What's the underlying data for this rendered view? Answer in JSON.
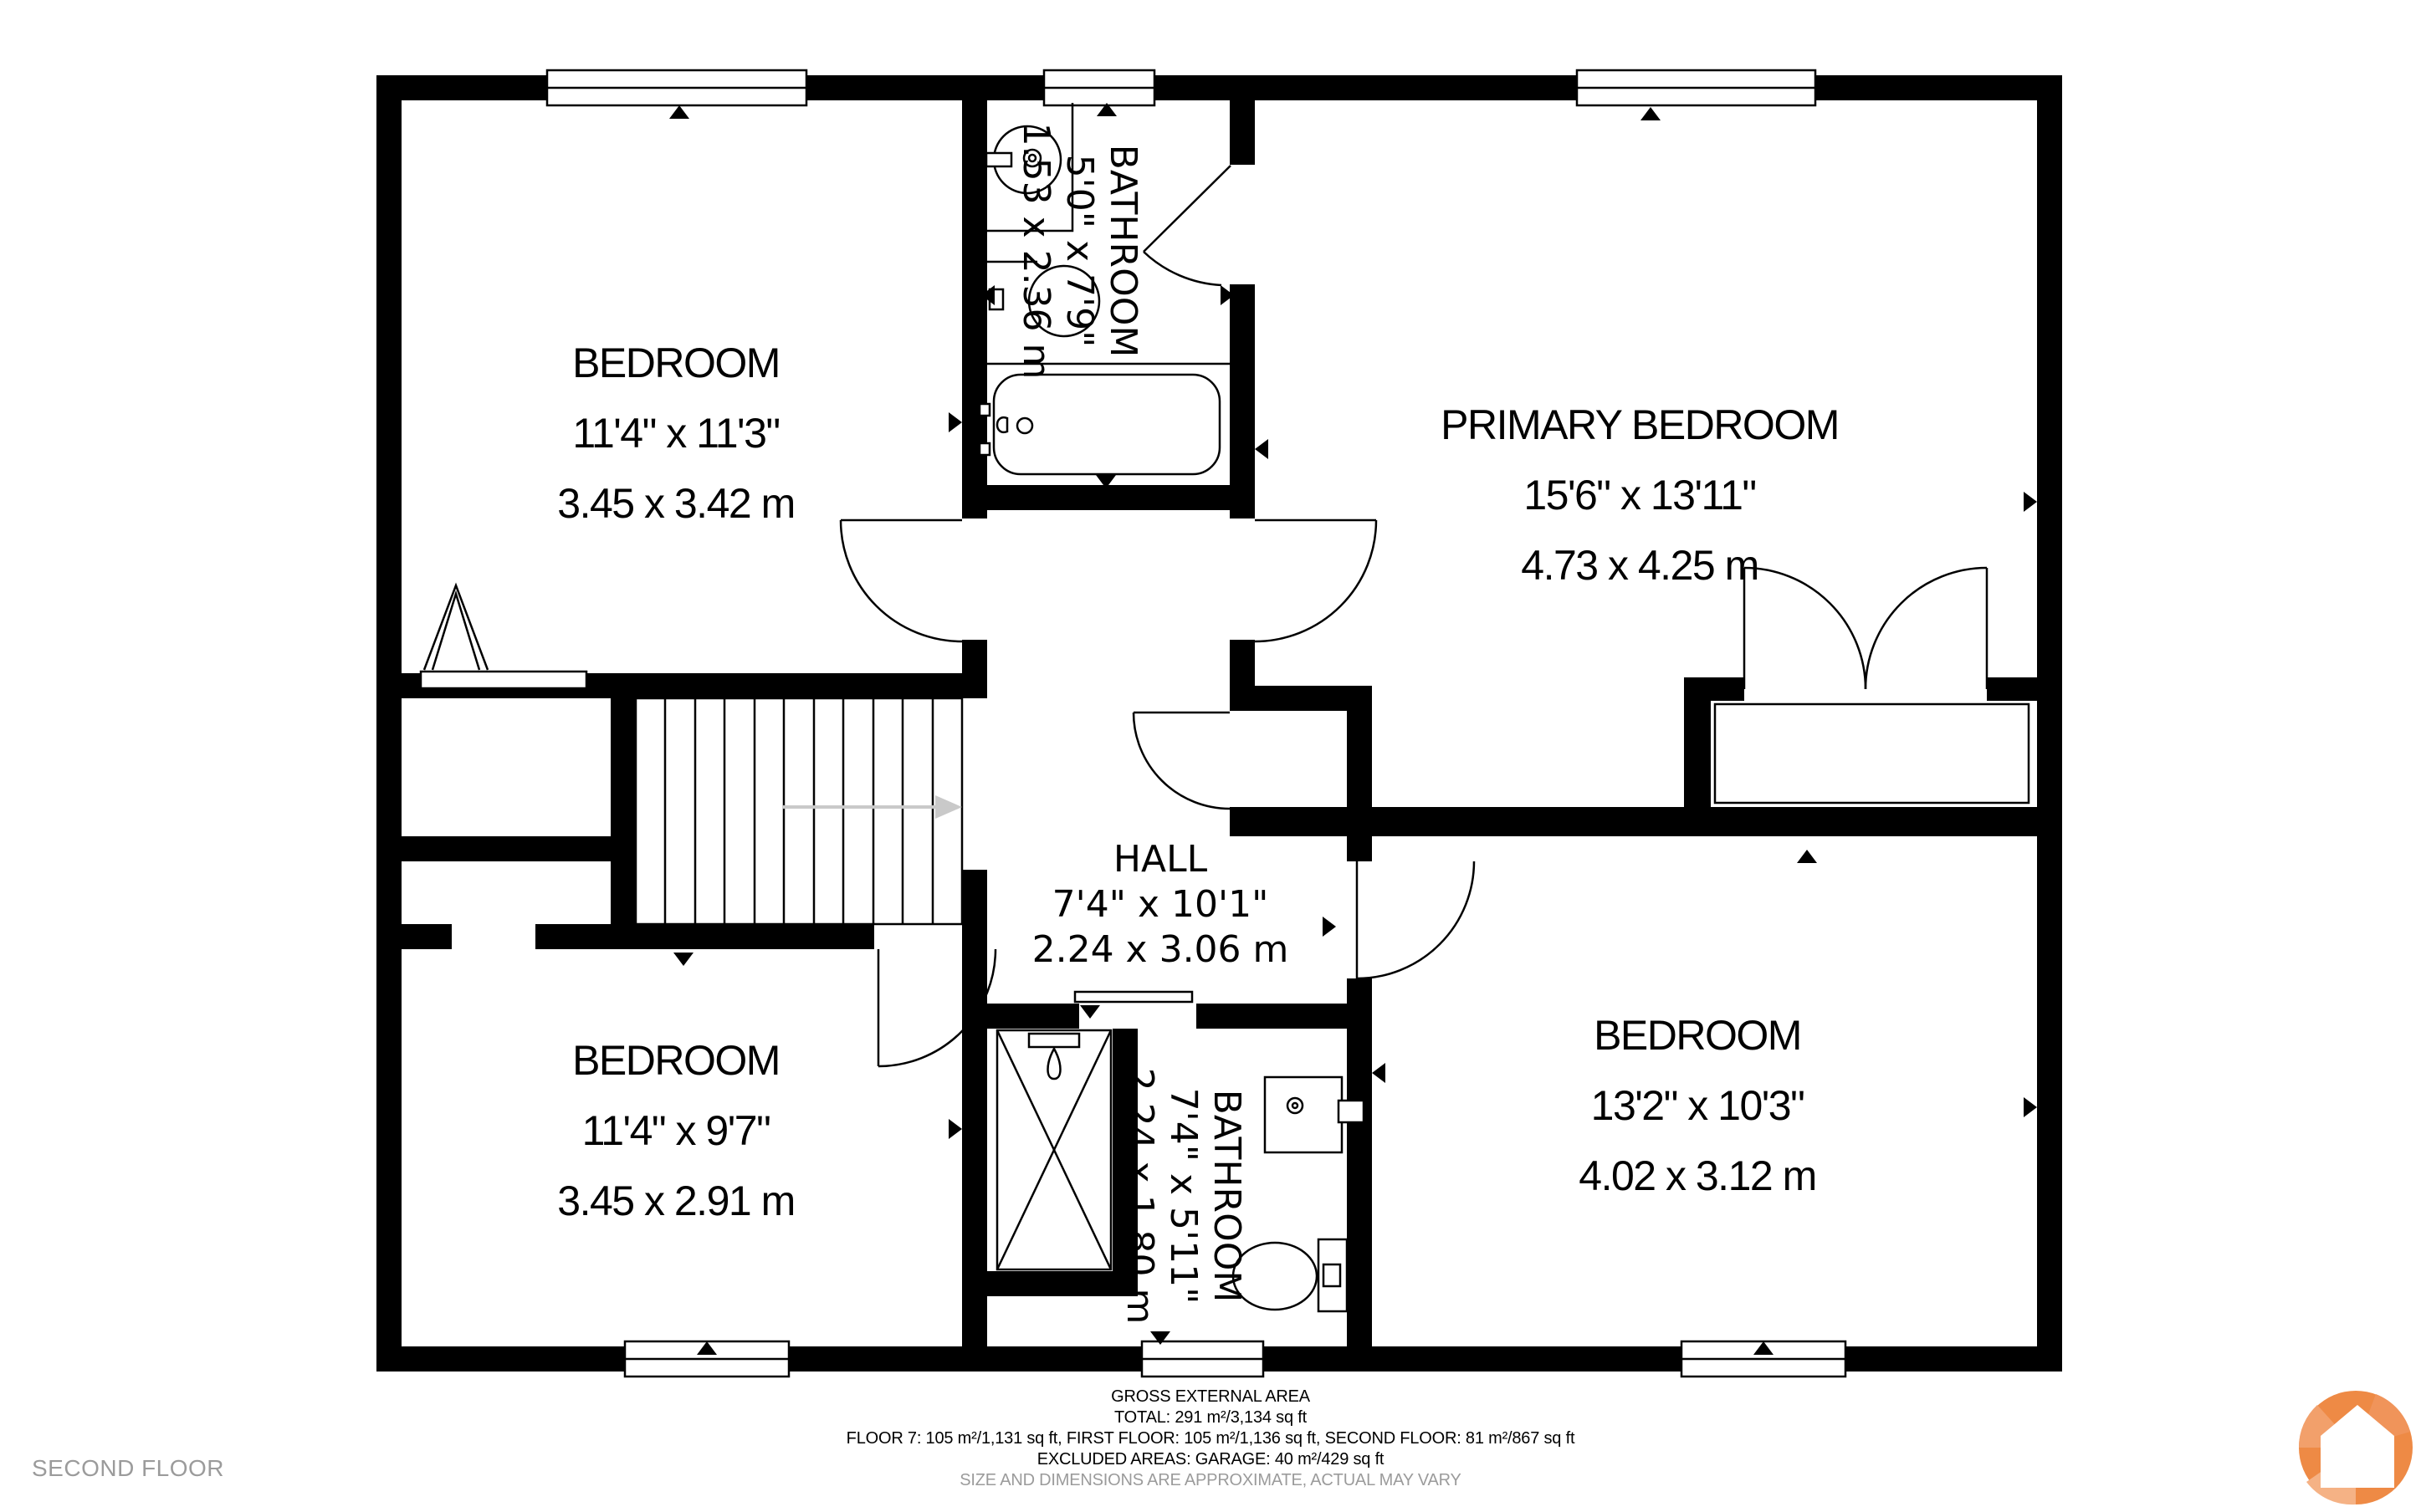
{
  "floor_label": "SECOND FLOOR",
  "rooms": [
    {
      "id": "bedroom-top-left",
      "name": "BEDROOM",
      "dim_ft": "11'4\" x 11'3\"",
      "dim_m": "3.45 x 3.42 m"
    },
    {
      "id": "bathroom-top",
      "name": "BATHROOM",
      "dim_ft": "5'0\" x 7'9\"",
      "dim_m": "1.53 x 2.36 m"
    },
    {
      "id": "primary-bedroom",
      "name": "PRIMARY BEDROOM",
      "dim_ft": "15'6\" x 13'11\"",
      "dim_m": "4.73 x 4.25 m"
    },
    {
      "id": "hall",
      "name": "HALL",
      "dim_ft": "7'4\" x 10'1\"",
      "dim_m": "2.24 x 3.06 m"
    },
    {
      "id": "bedroom-bottom-left",
      "name": "BEDROOM",
      "dim_ft": "11'4\" x 9'7\"",
      "dim_m": "3.45 x 2.91 m"
    },
    {
      "id": "bathroom-bottom",
      "name": "BATHROOM",
      "dim_ft": "7'4\" x 5'11\"",
      "dim_m": "2.24 x 1.80 m"
    },
    {
      "id": "bedroom-bottom-right",
      "name": "BEDROOM",
      "dim_ft": "13'2\" x 10'3\"",
      "dim_m": "4.02 x 3.12 m"
    }
  ],
  "footer": {
    "title": "GROSS EXTERNAL AREA",
    "total": "TOTAL: 291 m²/3,134 sq ft",
    "floors": "FLOOR 7: 105 m²/1,131 sq ft, FIRST FLOOR: 105 m²/1,136 sq ft, SECOND FLOOR: 81 m²/867 sq ft",
    "excluded": "EXCLUDED AREAS: GARAGE: 40 m²/429 sq ft",
    "disclaimer": "SIZE AND DIMENSIONS ARE APPROXIMATE, ACTUAL MAY VARY"
  },
  "colors": {
    "wall_black": "#000000",
    "logo_orange": "#EE8A45",
    "logo_orange_mid": "#F2A06B",
    "logo_orange_light": "#F5B285",
    "muted_gray": "#9B9B9B",
    "stairs_arrow_gray": "#C9C9C9"
  }
}
